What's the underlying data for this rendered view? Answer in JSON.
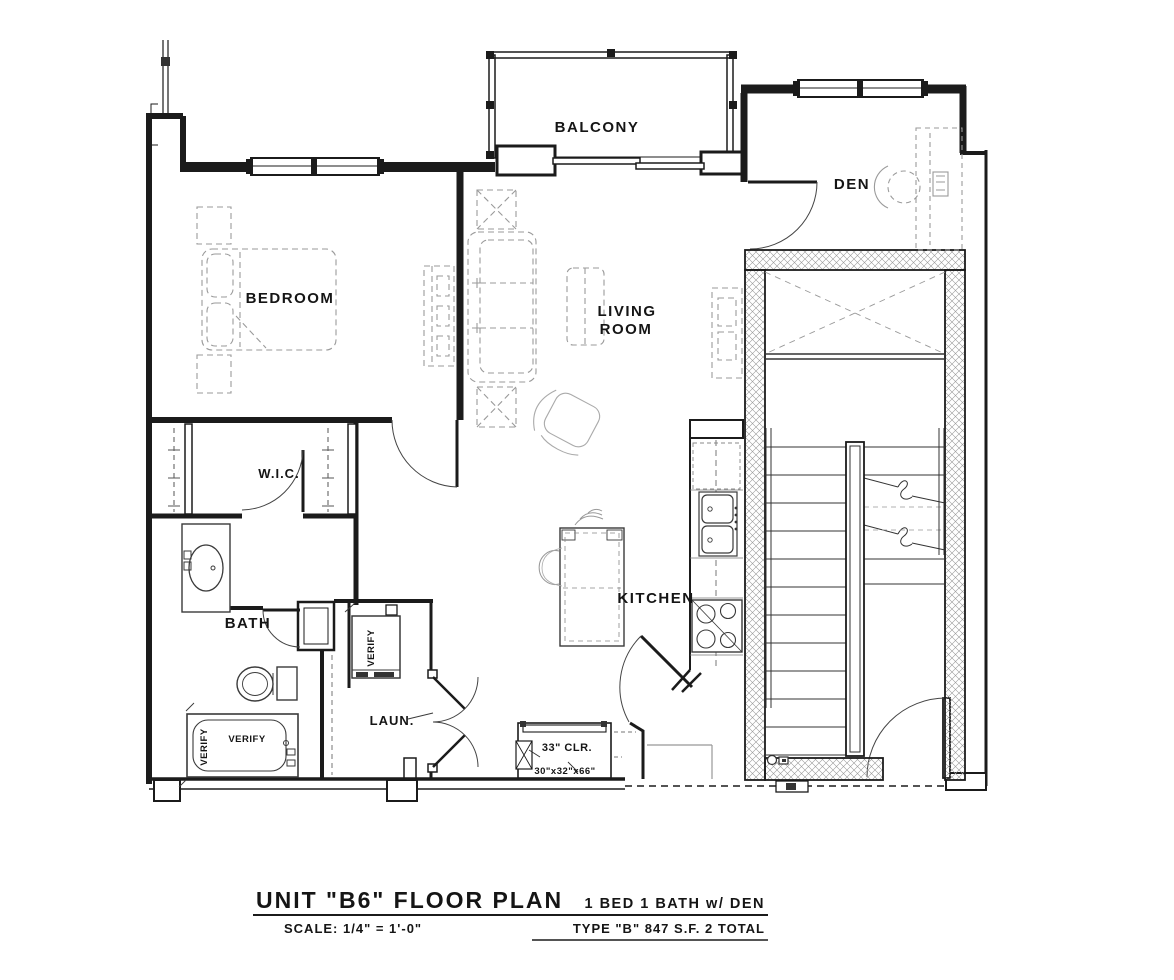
{
  "rooms": {
    "balcony": "BALCONY",
    "den": "DEN",
    "bedroom": "BEDROOM",
    "living_line1": "LIVING",
    "living_line2": "ROOM",
    "wic": "W.I.C.",
    "bath": "BATH",
    "kitchen": "KITCHEN",
    "laundry": "LAUN."
  },
  "annotations": {
    "verify_tub_h": "VERIFY",
    "verify_tub_v": "VERIFY",
    "verify_washer": "VERIFY",
    "clearance": "33\" CLR.",
    "water_heater_size": "30\"x32\"x66\""
  },
  "title_block": {
    "title": "UNIT \"B6\" FLOOR PLAN",
    "scale": "SCALE: 1/4\" = 1'-0\"",
    "summary": "1 BED 1 BATH w/ DEN",
    "type_info": "TYPE \"B\"   847 S.F.   2 TOTAL"
  },
  "colors": {
    "ink": "#1b1b1b",
    "fixture": "#3a3a3a",
    "furniture": "#9a9a9a",
    "hatch": "#9a9a9a"
  }
}
